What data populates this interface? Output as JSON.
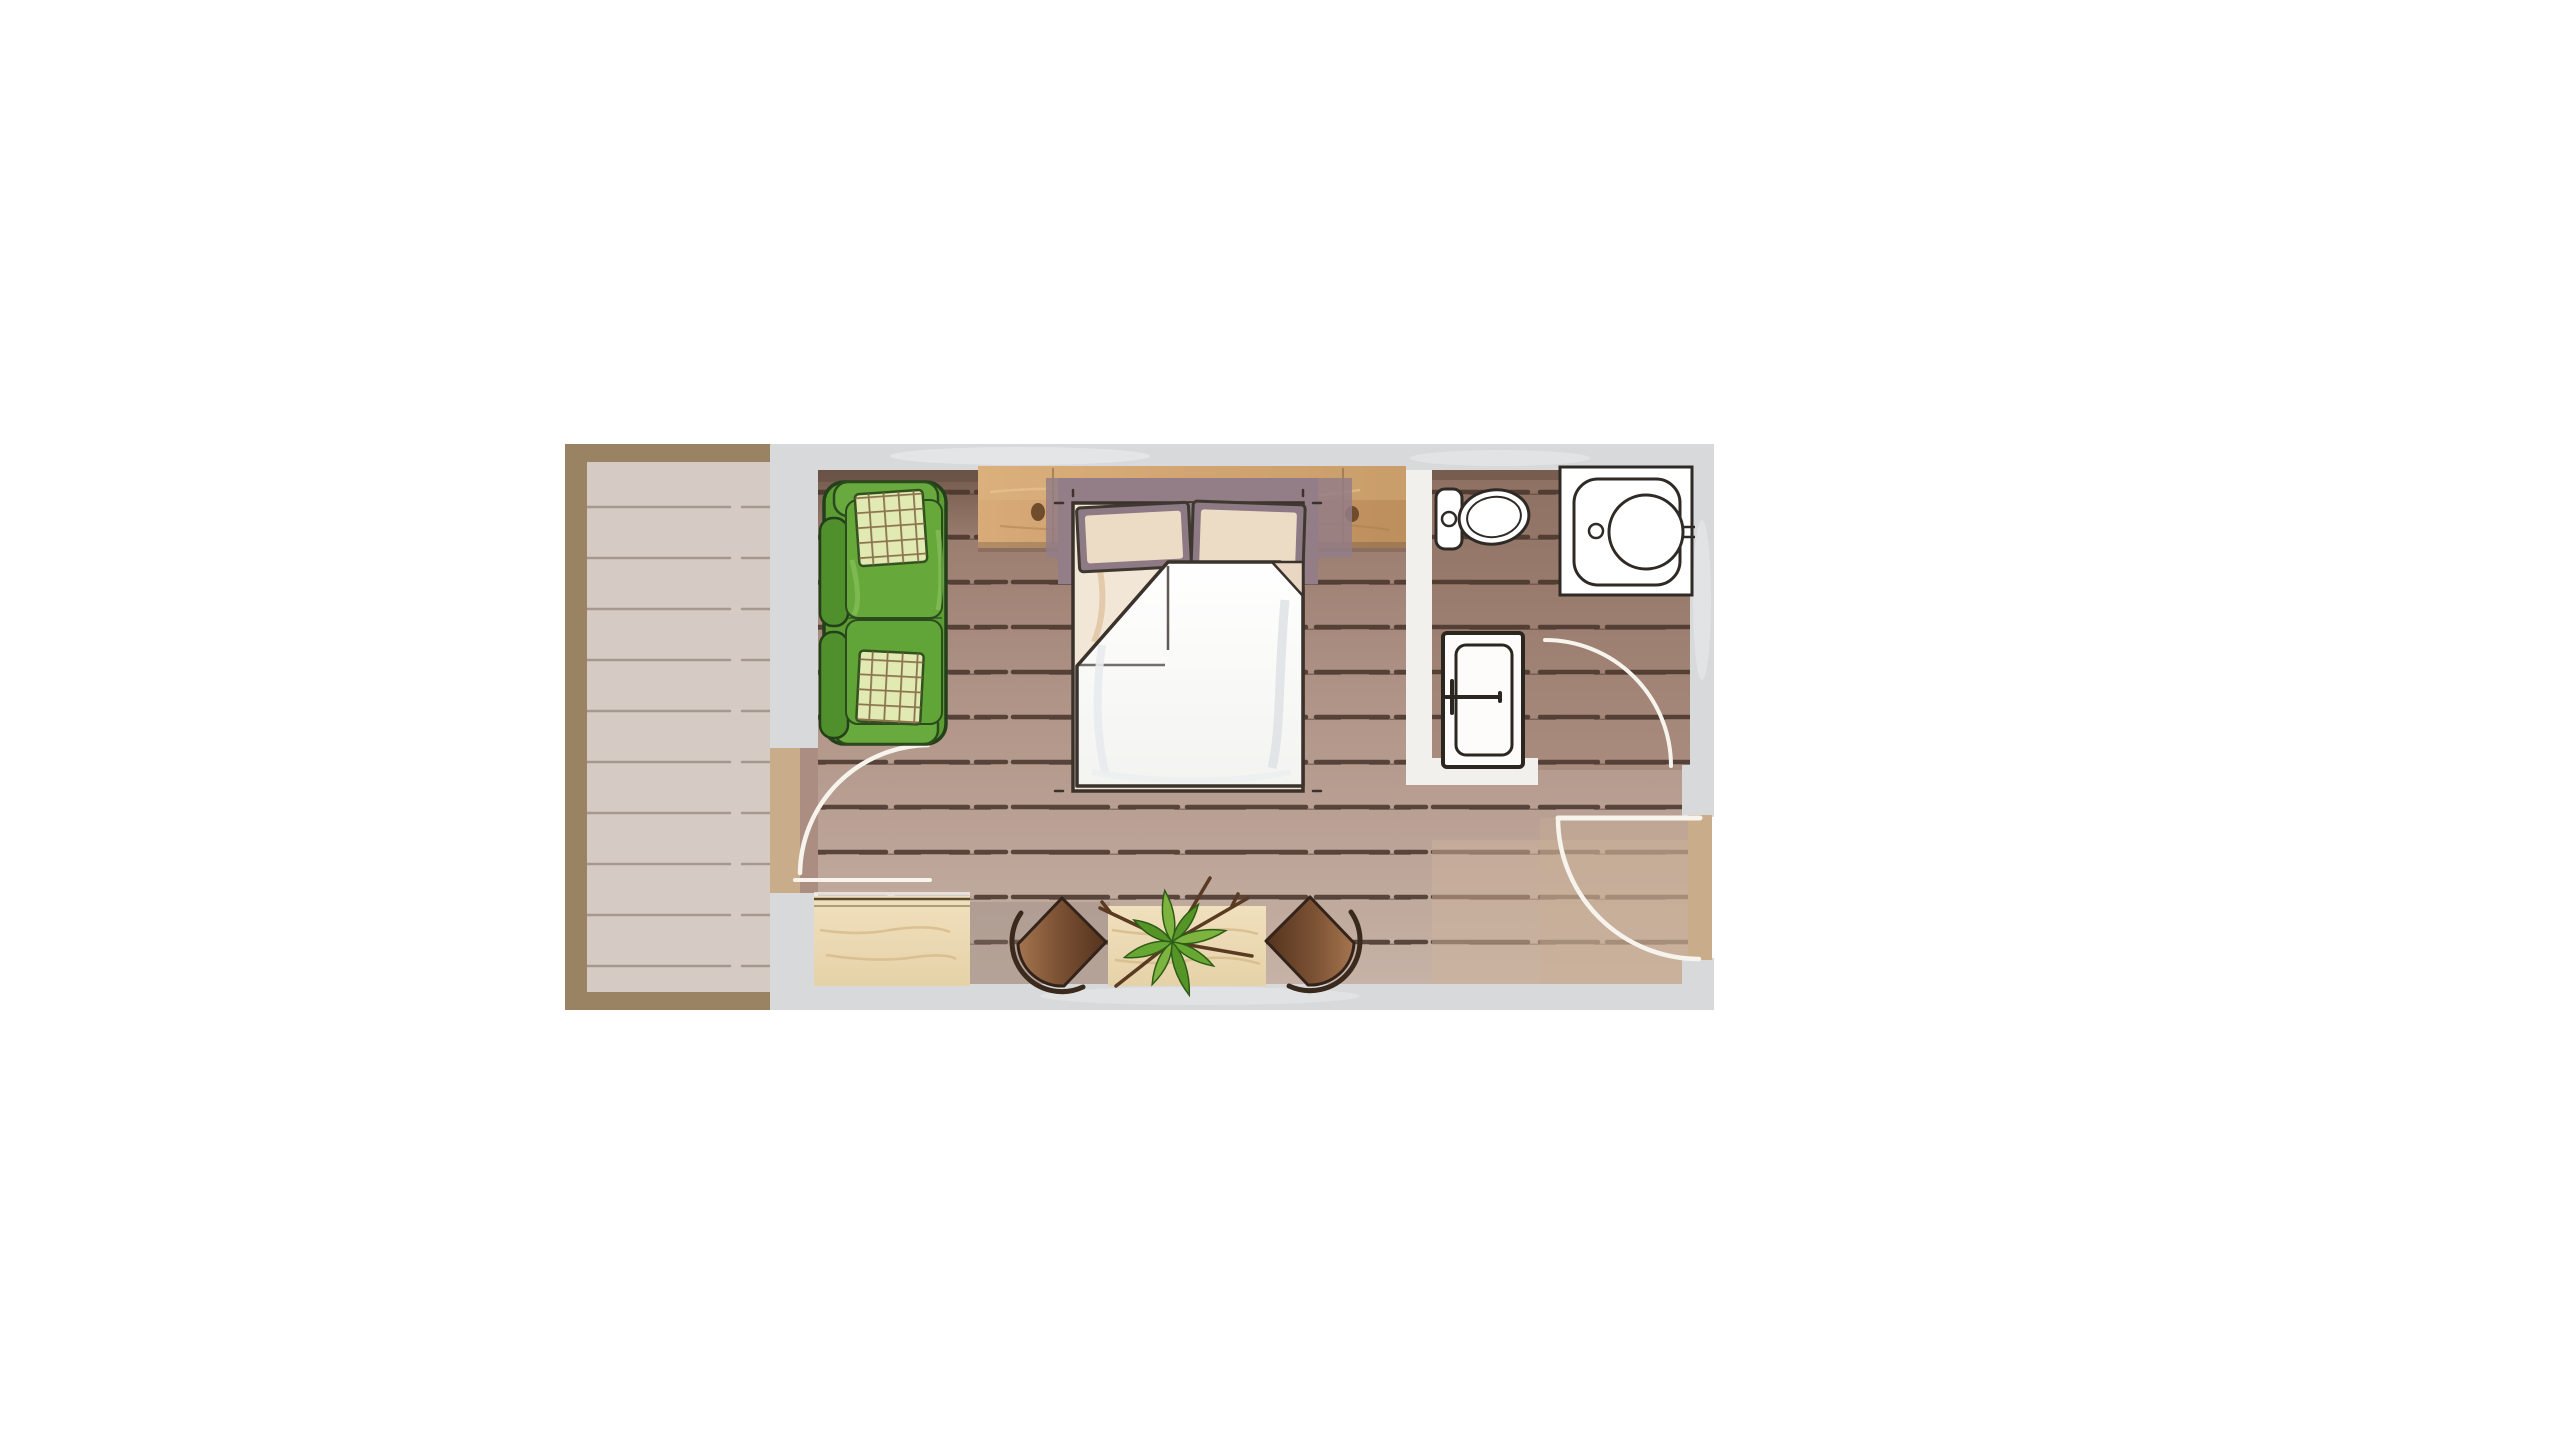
{
  "page": {
    "background": "#ffffff",
    "description": "Watercolor-style top-view floor plan of a studio hotel room with balcony and bathroom"
  },
  "plan": {
    "rooms": [
      {
        "id": "balcony",
        "label": "Balcony wood deck with frame border"
      },
      {
        "id": "bedroom",
        "label": "Bedroom / living area with plank floor"
      },
      {
        "id": "bathroom",
        "label": "Bathroom with toilet and washbasin"
      }
    ],
    "furniture": [
      {
        "id": "sofa",
        "label": "Two-seat green sofa with checkered cushions",
        "seat_count": 2,
        "cushion_count": 2
      },
      {
        "id": "headboard-shelf",
        "label": "Wooden headboard shelf with knots"
      },
      {
        "id": "double-bed",
        "label": "Double bed, white duvet with folded corner",
        "pillow_count": 2
      },
      {
        "id": "console",
        "label": "Light wood console bench"
      },
      {
        "id": "side-table",
        "label": "Light wood side table"
      },
      {
        "id": "pouf-left",
        "label": "Brown pouf chair facing right"
      },
      {
        "id": "pouf-right",
        "label": "Brown pouf chair facing left"
      },
      {
        "id": "plant",
        "label": "Star-leaf green plant on side table"
      }
    ],
    "fixtures": [
      {
        "id": "toilet",
        "label": "Toilet with tank and oval bowl"
      },
      {
        "id": "washbasin",
        "label": "Square washbasin unit with round basin and tap"
      }
    ],
    "doors": [
      {
        "id": "balcony-door",
        "label": "Balcony door",
        "swing": "quarter-circle white arc"
      },
      {
        "id": "bathroom-door",
        "label": "Bathroom door leaf with handle",
        "swing": "quarter-circle white arc"
      },
      {
        "id": "entry-door",
        "label": "Entry door in right wall",
        "swing": "quarter-circle white arc"
      }
    ]
  },
  "colors": {
    "wall": "#d8d9db",
    "wall_light": "#eceded",
    "interior_wall": "#f1f0ed",
    "balcony_frame": "#9a8362",
    "balcony_floor": "#d6cac4",
    "balcony_line": "#a2928a",
    "floor_dark": "#72594b",
    "floor_mid1": "#a1postcolor",
    "floor_mid": "#b09487",
    "floor_light": "#c6b2a6",
    "floor_entry_tan": "#c9af94",
    "bath_floor_dark": "#8d7062",
    "bath_floor_light": "#a98c7e",
    "plank_line": "#46342a",
    "wood_light": "#d8ab78",
    "wood_dark": "#bd8f5c",
    "wood_knot": "#6f4c2c",
    "console_wood_light": "#f0e0bd",
    "console_wood_dark": "#e6d2a8",
    "console_grain": "#d6b98a",
    "sofa_green": "#5b9c33",
    "sofa_green_dark": "#4f8f2c",
    "sofa_green_seat": "#66a93a",
    "sofa_outline": "#24401a",
    "cushion_pale": "#e0eab2",
    "cushion_grid": "#7d5f3d",
    "bed_backdrop_mauve": "#937d87",
    "pillow_fill": "#ecdcc6",
    "pillow_frame": "#8d7a84",
    "mattress": "#f2e6d6",
    "duvet": "#ffffff",
    "sketch_line": "#3a322b",
    "fixture_line": "#2f2a25",
    "chair_light": "#a5754f",
    "chair_dark": "#54331e",
    "chair_outline": "#33231a",
    "plant_green": "#7db33f",
    "plant_green_dark": "#559427",
    "twig_brown": "#5a3b22",
    "door_arc": "#f7f4ee",
    "threshold_tan": "#c9ad8a"
  }
}
